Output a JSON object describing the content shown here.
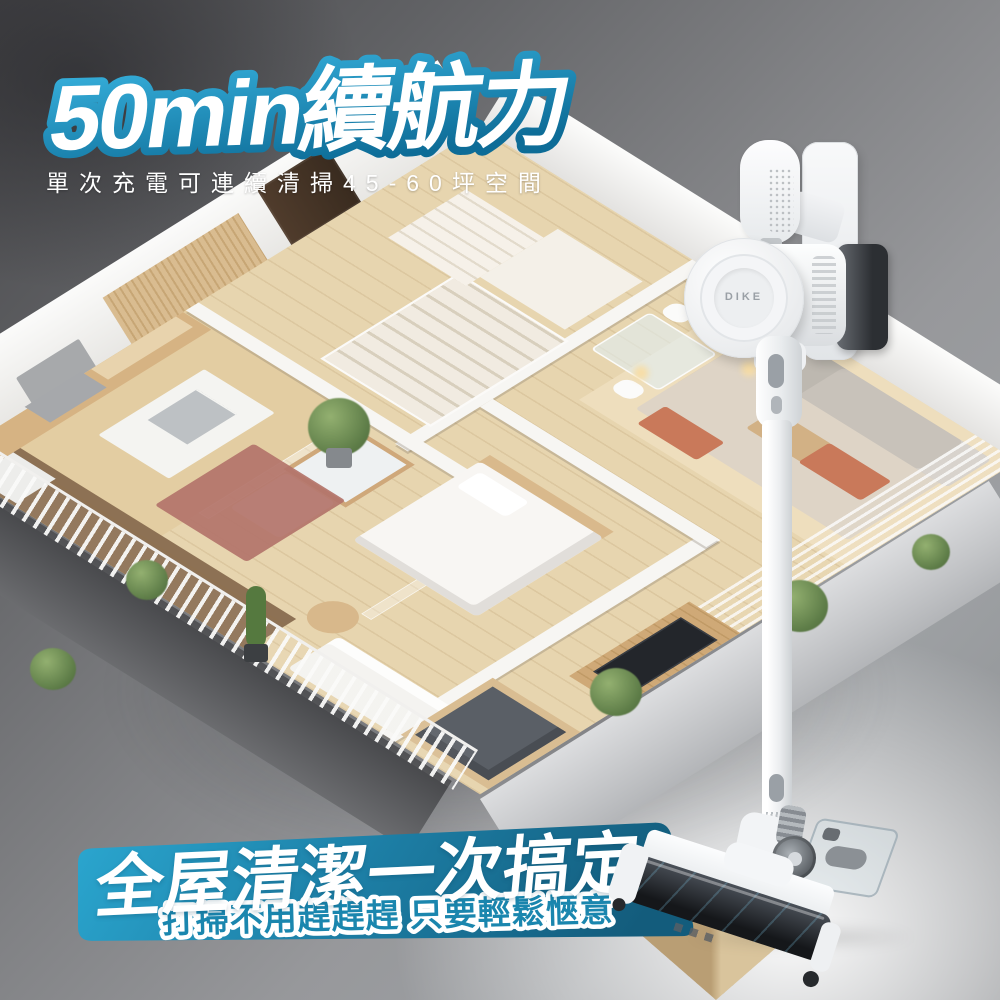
{
  "page": {
    "title": "50min續航力",
    "subtitle": "單次充電可連續清掃45-60坪空間"
  },
  "banner": {
    "headline": "全屋清潔一次搞定!",
    "subline": "打掃不用趕趕趕 只要輕鬆愜意"
  },
  "product": {
    "brand_label": "DIKE"
  },
  "colors": {
    "title_fill": "#FFFFFF",
    "title_outline_top": "#38B2DE",
    "title_outline_bottom": "#0D6C97",
    "banner_left": "#2BA7D0",
    "banner_mid": "#1D7FA6",
    "banner_right": "#135C7C",
    "banner_subtext_blue": "#1A86AE",
    "background_dark_gray": "#47474A",
    "background_light_gray": "#9DA0A3",
    "floor_wood": "#E7D5AF",
    "accent_terracotta": "#C9795A"
  }
}
